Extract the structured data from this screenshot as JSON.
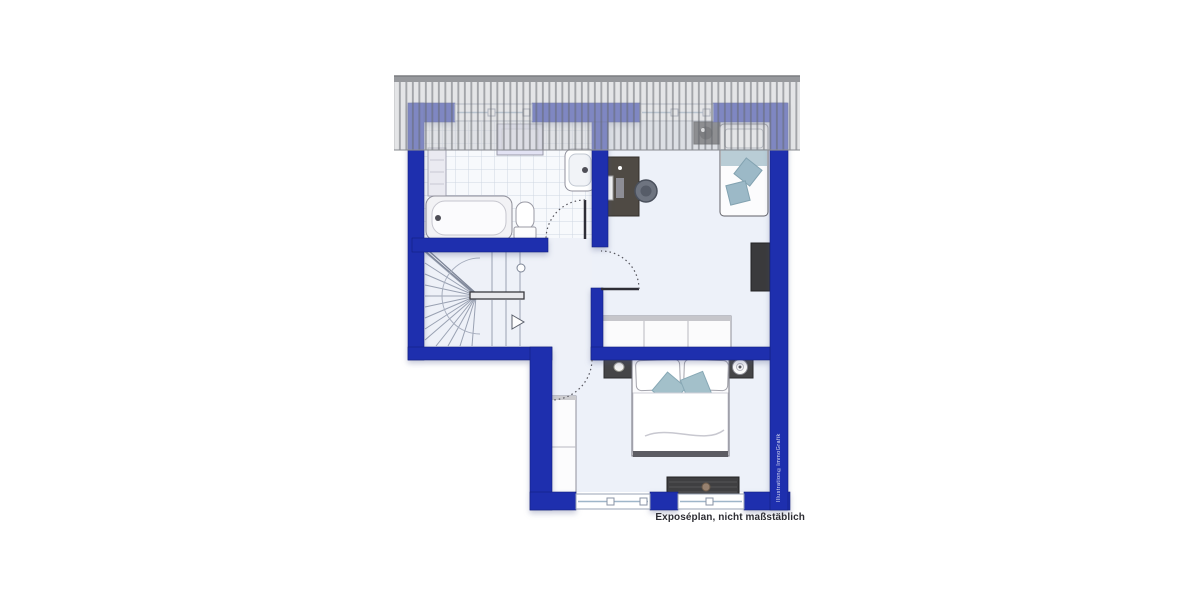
{
  "artwork": {
    "kind": "floor-plan-illustration",
    "caption": "Exposéplan, nicht maßstäblich",
    "watermark": "Illustration©ImmoGrafik"
  },
  "palette": {
    "wall_blue": "#1e2fae",
    "wall_blue_dark": "#13207e",
    "roof_gray": "#c9cbce",
    "roof_stripe": "#63666c",
    "floor_tint": "#edf1f9",
    "tile_line": "#cfd6e2",
    "furniture_dark": "#454547",
    "desk_brown": "#4f4a44",
    "cushion_blue": "#9fbcca",
    "blanket_blue": "#b9cdd6",
    "white": "#ffffff"
  },
  "depicted_elements": [
    "roof-overhang-hatching",
    "bathroom-with-bathtub-toilet-sink-washer",
    "winder-staircase-with-direction-arrow",
    "hallway-with-door-swings",
    "study-room-with-desk-chair-single-bed",
    "bedroom-with-double-bed-wardrobes-lowboard",
    "four-windows"
  ]
}
